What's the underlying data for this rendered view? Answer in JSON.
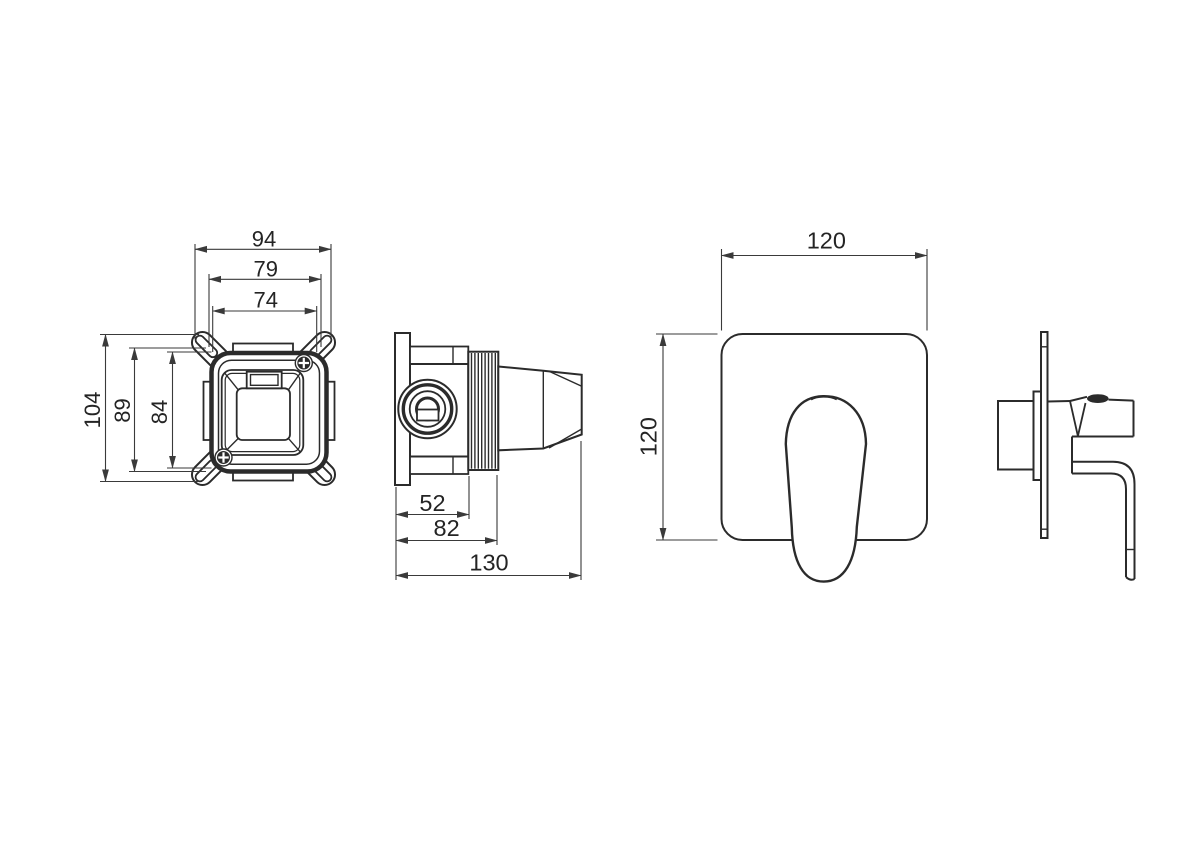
{
  "palette": {
    "background": "#ffffff",
    "object_line": "#2b2b2b",
    "dimension_line": "#3a3a3a",
    "text": "#242424"
  },
  "views": {
    "valve_front": {
      "horizontal_dims": {
        "outer": "94",
        "mounting": "79",
        "inner": "74"
      },
      "vertical_dims": {
        "outer": "104",
        "mounting": "89",
        "inner": "84"
      }
    },
    "valve_side": {
      "dims": {
        "body_depth": "52",
        "thread_depth": "82",
        "total_depth": "130"
      }
    },
    "plate_front": {
      "dims": {
        "width": "120",
        "height": "120"
      }
    }
  }
}
